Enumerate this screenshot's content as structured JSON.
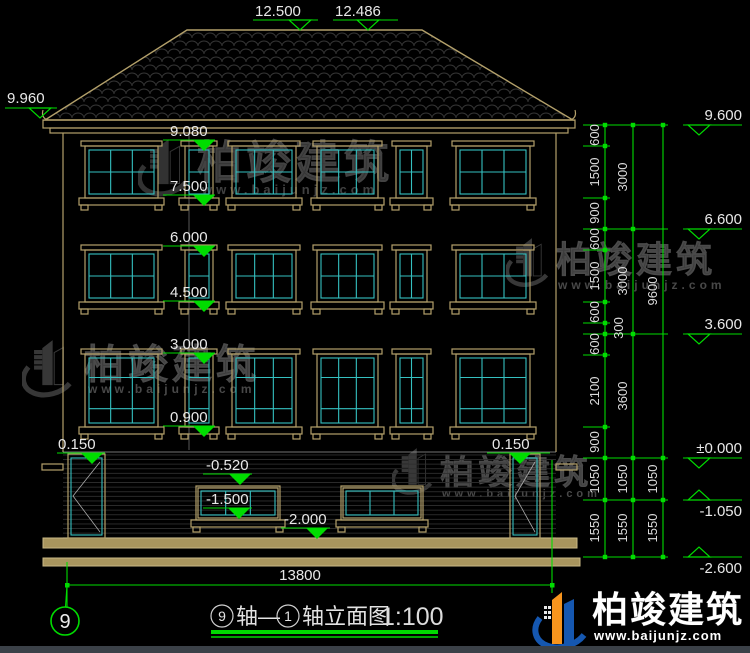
{
  "elevation_markers": {
    "m12500": "12.500",
    "m12486": "12.486",
    "m9960": "9.960",
    "m9600": "9.600",
    "m6600": "6.600",
    "m3600": "3.600",
    "m0000": "±0.000",
    "mneg1050": "-1.050",
    "mneg2600": "-2.600"
  },
  "level_labels": {
    "l9080": "9.080",
    "l7500": "7.500",
    "l6000": "6.000",
    "l4500": "4.500",
    "l3000": "3.000",
    "l0900": "0.900",
    "l0150_left": "0.150",
    "l0150_right": "0.150",
    "lneg0520": "-0.520",
    "lneg1500": "-1.500",
    "lneg2000": "-2.000"
  },
  "dimensions": {
    "col1": [
      "600",
      "1500",
      "900",
      "600",
      "1500",
      "600",
      "300",
      "600",
      "2100",
      "900",
      "1050",
      "1550"
    ],
    "col2": [
      "3000",
      "3000",
      "3600",
      "1050",
      "1550"
    ],
    "col3": [
      "9600",
      "1050",
      "1550"
    ],
    "overall_width": "13800"
  },
  "axis_bubble": "9",
  "title": {
    "axis_start_no": "9",
    "axis_start_label": "轴—",
    "axis_end_no": "1",
    "axis_end_label": "轴立面图",
    "scale": "1:100"
  },
  "watermark": {
    "brand": "柏竣建筑",
    "site": "www.baijunjz.com"
  }
}
